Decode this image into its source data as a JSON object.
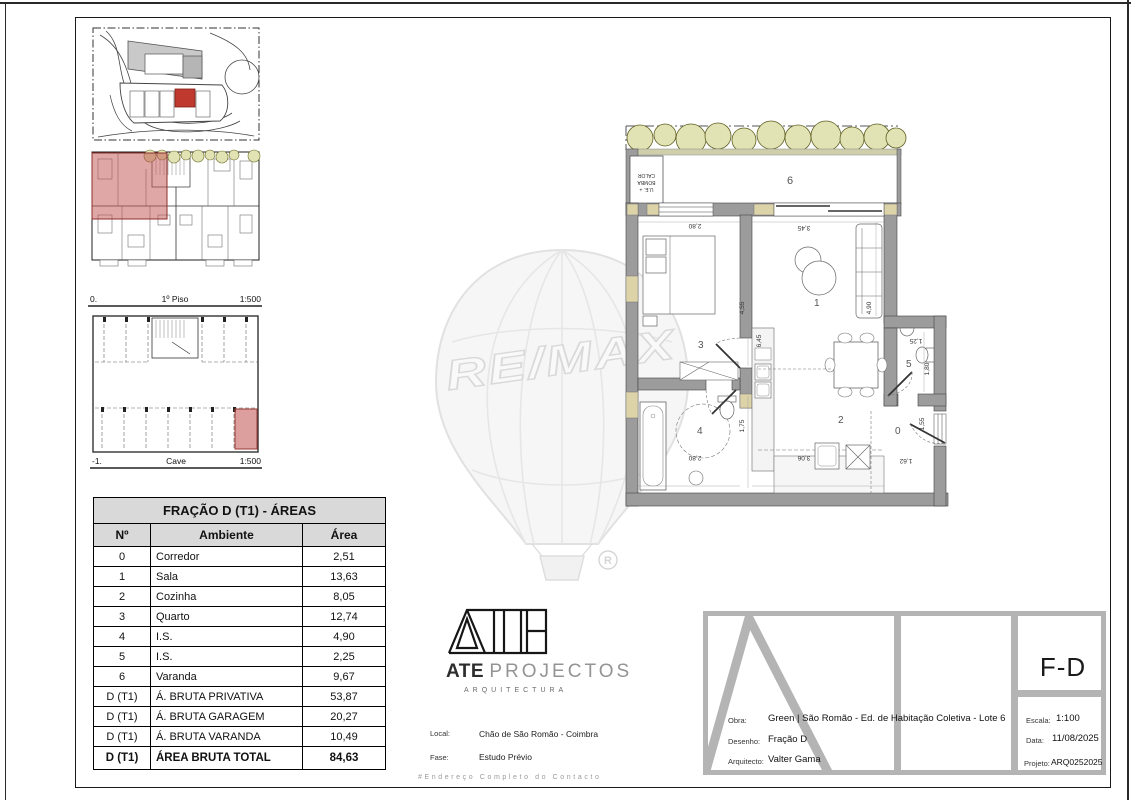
{
  "colors": {
    "highlight_red": "#c0392e",
    "overlay_red": "#c0504d",
    "wall_gray": "#9c9c9c",
    "tree_green": "#e2e3b4",
    "titleblock_gray": "#b4b4b4"
  },
  "thumbs": {
    "piso": {
      "left_marker": "0.",
      "title": "1º Piso",
      "scale": "1:500"
    },
    "cave": {
      "left_marker": "-1.",
      "title": "Cave",
      "scale": "1:500"
    }
  },
  "areas_table": {
    "title": "FRAÇÃO D (T1) - ÁREAS",
    "columns": [
      "Nº",
      "Ambiente",
      "Área"
    ],
    "rows": [
      {
        "no": "0",
        "ambiente": "Corredor",
        "area": "2,51"
      },
      {
        "no": "1",
        "ambiente": "Sala",
        "area": "13,63"
      },
      {
        "no": "2",
        "ambiente": "Cozinha",
        "area": "8,05"
      },
      {
        "no": "3",
        "ambiente": "Quarto",
        "area": "12,74"
      },
      {
        "no": "4",
        "ambiente": "I.S.",
        "area": "4,90"
      },
      {
        "no": "5",
        "ambiente": "I.S.",
        "area": "2,25"
      },
      {
        "no": "6",
        "ambiente": "Varanda",
        "area": "9,67"
      },
      {
        "no": "D (T1)",
        "ambiente": "Á. BRUTA PRIVATIVA",
        "area": "53,87"
      },
      {
        "no": "D (T1)",
        "ambiente": "Á. BRUTA GARAGEM",
        "area": "20,27"
      },
      {
        "no": "D (T1)",
        "ambiente": "Á. BRUTA VARANDA",
        "area": "10,49"
      }
    ],
    "total": {
      "no": "D (T1)",
      "ambiente": "ÁREA BRUTA TOTAL",
      "area": "84,63"
    }
  },
  "plan": {
    "rooms": {
      "corredor": "0",
      "sala": "1",
      "cozinha": "2",
      "quarto": "3",
      "is4": "4",
      "is5": "5",
      "varanda": "6"
    },
    "equip_lines": [
      "U.E. +",
      "BOMBA",
      "CALOR"
    ],
    "dims": {
      "quarto_w": "2,80",
      "sala_w": "3,45",
      "mid_a": "4,55",
      "mid_b": "6,45",
      "sala_h": "4,90",
      "is_h": "1,75",
      "is_w": "2,80",
      "coz_w": "3,06",
      "corr_w": "1,62",
      "is5_w": "1,25",
      "is5_h": "1,80",
      "corr_h": "1,55"
    }
  },
  "watermark": {
    "brand": "RE/MAX",
    "registered": "®"
  },
  "ate": {
    "name_bold": "ATE",
    "name_light": "PROJECTOS",
    "subtitle": "ARQUITECTURA",
    "local_label": "Local:",
    "local_value": "Chão de São Romão - Coimbra",
    "fase_label": "Fase:",
    "fase_value": "Estudo Prévio",
    "footer_note": "#Endereço Completo do Contacto"
  },
  "title_block": {
    "obra_label": "Obra:",
    "obra_value": "Green | São Romão - Ed. de Habitação Coletiva - Lote 6",
    "desenho_label": "Desenho:",
    "desenho_value": "Fração D",
    "arquitecto_label": "Arquitecto:",
    "arquitecto_value": "Valter Gama",
    "code": "F-D",
    "escala_label": "Escala:",
    "escala_value": "1:100",
    "data_label": "Data:",
    "data_value": "11/08/2025",
    "projeto_label": "Projeto:",
    "projeto_value": "ARQ0252025"
  }
}
